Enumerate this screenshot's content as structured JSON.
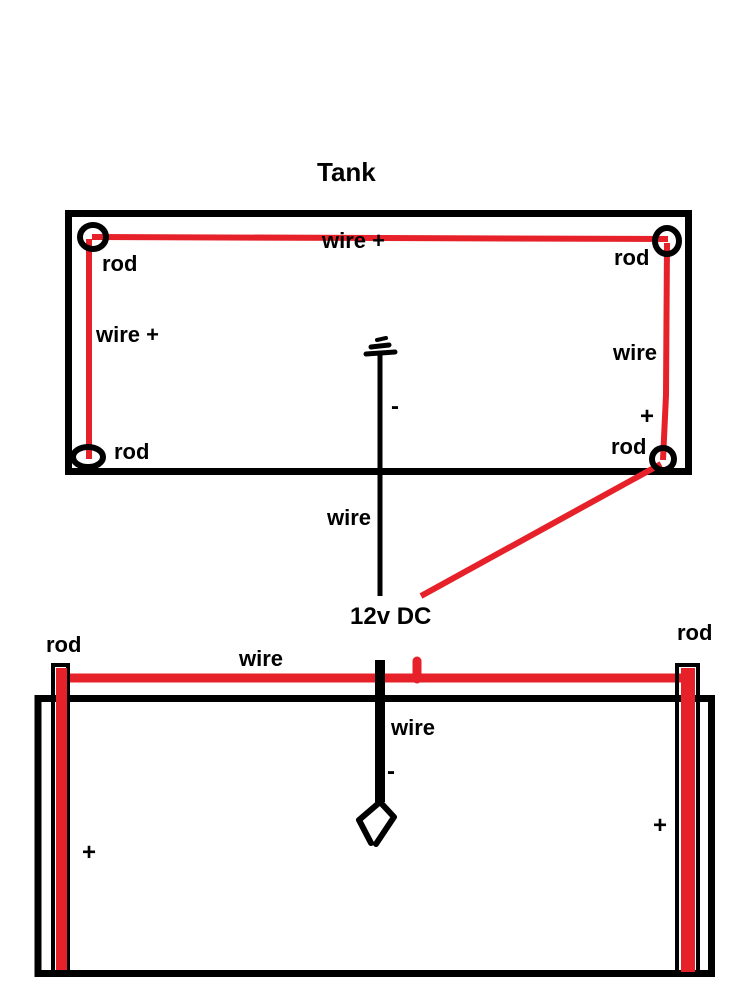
{
  "diagram": {
    "title": "Tank",
    "colors": {
      "wire_red": "#E62129",
      "ink": "#000000",
      "paper": "#FFFFFF"
    },
    "top_view": {
      "wire_top_label": "wire +",
      "wire_left_label": "wire +",
      "wire_right_label": "wire",
      "wire_right_polarity": "+",
      "rod_top_left": "rod",
      "rod_top_right": "rod",
      "rod_bottom_left": "rod",
      "rod_bottom_right": "rod",
      "center_wire_polarity": "-",
      "center_wire_label": "wire"
    },
    "power_supply": {
      "label": "12v DC"
    },
    "side_view": {
      "rod_left_label": "rod",
      "rod_right_label": "rod",
      "top_wire_label": "wire",
      "center_wire_label": "wire",
      "center_wire_polarity": "-",
      "left_rod_polarity": "+",
      "right_rod_polarity": "+"
    }
  }
}
